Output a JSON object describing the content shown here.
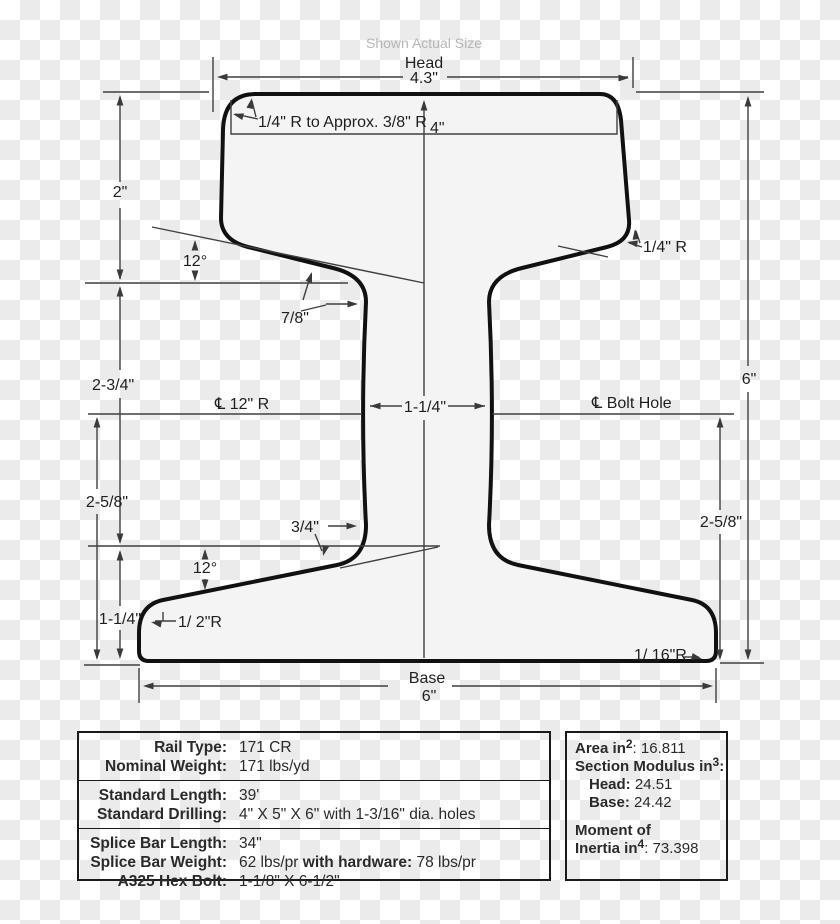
{
  "title": {
    "shown_actual_size": "Shown Actual Size"
  },
  "diagram": {
    "head_label": "Head",
    "head_width": "4.3\"",
    "radius_note": "1/4\" R to Approx. 3/8\" R",
    "head_height": "4\"",
    "dim_2in": "2\"",
    "angle_upper": "12°",
    "dim_7_8": "7/8\"",
    "radius_quarter_right": "1/4\" R",
    "dim_2_3_4": "2-3/4\"",
    "centerline_12r": "℄ 12\" R",
    "web_thickness": "1-1/4\"",
    "centerline_bolt_hole": "℄ Bolt Hole",
    "overall_height": "6\"",
    "dim_2_5_8_left": "2-5/8\"",
    "dim_3_4": "3/4\"",
    "angle_lower": "12°",
    "dim_1_1_4_base": "1-1/4\"",
    "radius_half": "1/ 2\"R",
    "dim_2_5_8_right": "2-5/8\"",
    "radius_1_16": "1/ 16\"R",
    "base_label": "Base",
    "base_width": "6\""
  },
  "spec_table": {
    "rows": [
      {
        "label": "Rail Type:",
        "value": "171 CR"
      },
      {
        "label": "Nominal Weight:",
        "value": "171 lbs/yd"
      },
      {
        "label": "Standard Length:",
        "value": "39'"
      },
      {
        "label": "Standard Drilling:",
        "value": "4\" X 5\" X 6\" with 1-3/16\" dia. holes"
      },
      {
        "label": "Splice Bar Length:",
        "value": "34\""
      },
      {
        "label": "Splice Bar Weight:",
        "value_start": "62 lbs/pr ",
        "value_bold": "with hardware:",
        "value_end": " 78 lbs/pr"
      },
      {
        "label": "A325 Hex Bolt:",
        "value": "1-1/8\" X 6-1/2\""
      }
    ]
  },
  "properties_table": {
    "area": {
      "label": "Area in",
      "sup": "2",
      "value": ": 16.811"
    },
    "section_modulus": {
      "label": "Section Modulus in",
      "sup": "3",
      "value": ":"
    },
    "head": {
      "label": "Head:",
      "value": " 24.51"
    },
    "base": {
      "label": "Base:",
      "value": " 24.42"
    },
    "moment_line_1": "Moment of",
    "moment": {
      "label": "Inertia in",
      "sup": "4",
      "value": ": 73.398"
    }
  }
}
